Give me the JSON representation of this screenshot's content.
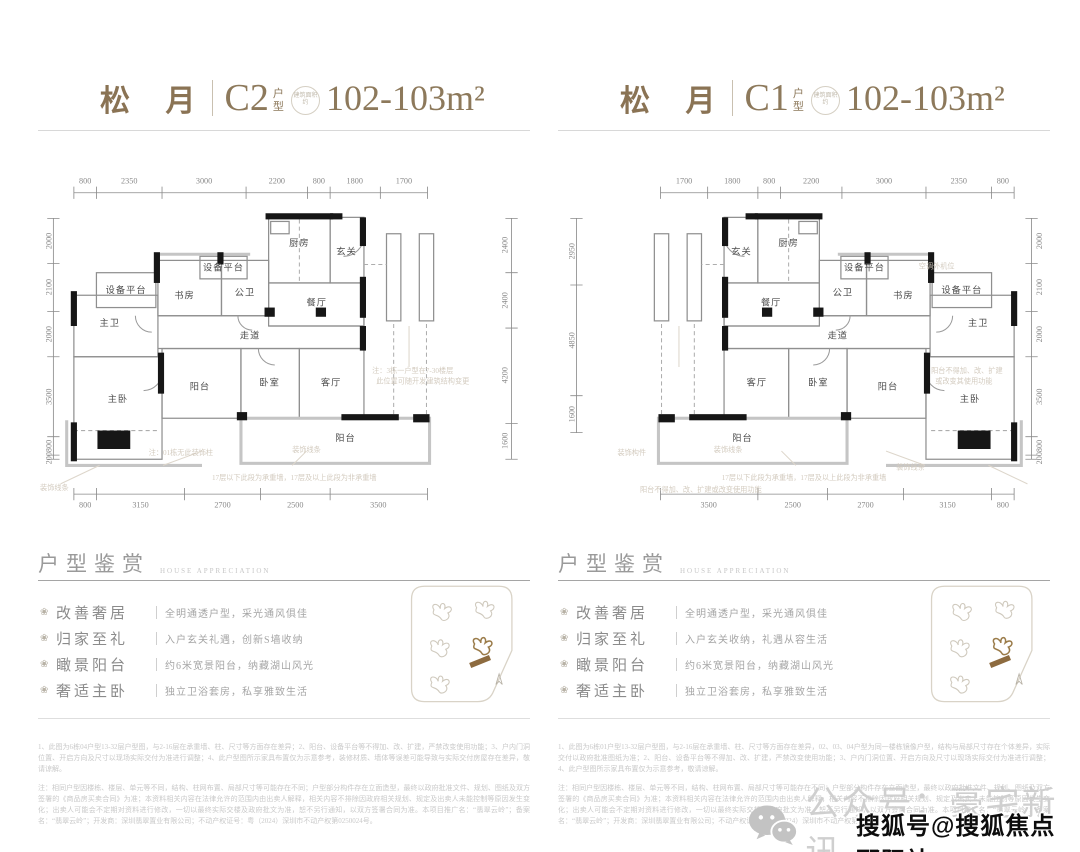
{
  "watermark": {
    "wechat_label": "公众号：豪宅新讯",
    "sohu_label": "搜狐号@搜狐焦点邵阳站"
  },
  "columns": {
    "left": {
      "title": {
        "project": "松 月",
        "type_code": "C2",
        "type_label": "户型",
        "badge": "建筑面积约",
        "area": "102-103m²"
      },
      "plan": {
        "dims_top": [
          "800",
          "2350",
          "3000",
          "2200",
          "800",
          "1800",
          "1700"
        ],
        "dims_bottom": [
          "800",
          "3150",
          "2700",
          "2500",
          "3500"
        ],
        "dims_left": [
          "2000",
          "2100",
          "2000",
          "3500",
          "800",
          "200"
        ],
        "dims_right": [
          "2400",
          "2400",
          "4200",
          "1600"
        ],
        "rooms": {
          "equip_left": "设备平台",
          "equip_up": "设备平台",
          "study": "书房",
          "pub_bath": "公卫",
          "kitchen": "厨房",
          "entry": "玄关",
          "dining": "餐厅",
          "master_bath": "主卫",
          "corridor": "走道",
          "master_bed": "主卧",
          "balcony_small": "阳台",
          "bedroom": "卧室",
          "living": "客厅",
          "balcony_wide": "阳台"
        },
        "notes": {
          "deco_line": "装饰线条",
          "no_column": "注：01栋无此装饰柱",
          "deco_line2": "装饰线条",
          "bearing_wall": "17层以下此段为承重墙，17层及以上此段为非承重墙",
          "floor_note_1": "注：3栋一户型在7-30楼层",
          "floor_note_2": "此位置可随开发建筑结构变更"
        }
      },
      "appreciation": {
        "heading": "户型鉴赏",
        "heading_en": "HOUSE APPRECIATION",
        "features": [
          {
            "key": "改善奢居",
            "value": "全明通透户型，采光通风俱佳"
          },
          {
            "key": "归家至礼",
            "value": "入户玄关礼遇，创新S墙收纳"
          },
          {
            "key": "瞰景阳台",
            "value": "约6米宽景阳台，纳藏湖山风光"
          },
          {
            "key": "奢适主卧",
            "value": "独立卫浴套房，私享雅致生活"
          }
        ]
      },
      "disclaimer": {
        "p1": "1、此图为6栋04户型13-32层户型图，与2-16层在承重墙、柱、尺寸等方面存在差异；2、阳台、设备平台等不得加、改、扩建，严禁改变使用功能；3、户内门洞位置、开启方向及尺寸以现场实际交付为准进行调整；4、此户型图所示家具布置仅为示意参考，装修材质、墙体等误差可能导致与实际交付房屋存在差异，敬请谅解。",
        "p2": "注：相同户型因楼栋、楼层、单元等不同，结构、柱网布置、局部尺寸等可能存在不同；户型部分构件存在立面造型，最终以政府批准文件、规划、图纸及双方签署的《商品房买卖合同》为准；本资料相关内容在法律允许的范围内由出卖人解释，相关内容不排除因政府相关规划、规定及出卖人未能控制等原因发生变化；出卖人可能会不定期对资料进行修改，一切以最终实际交楼及政府批文为准，恕不另行通知，以双方签署合同为准。本项目推广名：“翡翠云岭”；备案名：“翡翠云岭”；开发商：深圳翡翠置业有限公司；不动产权证号：粤（2024）深圳市不动产权第0250024号。"
      }
    },
    "right": {
      "title": {
        "project": "松 月",
        "type_code": "C1",
        "type_label": "户型",
        "badge": "建筑面积约",
        "area": "102-103m²"
      },
      "plan": {
        "dims_top": [
          "1700",
          "1800",
          "800",
          "2200",
          "3000",
          "2350",
          "800"
        ],
        "dims_bottom": [
          "3500",
          "2500",
          "2700",
          "3150",
          "800"
        ],
        "dims_left": [
          "2950",
          "4850",
          "1600"
        ],
        "dims_right": [
          "2000",
          "2100",
          "2000",
          "3500",
          "800",
          "200"
        ],
        "rooms": {
          "equip_left": "设备平台",
          "equip_up": "设备平台",
          "study": "书房",
          "pub_bath": "公卫",
          "kitchen": "厨房",
          "entry": "玄关",
          "dining": "餐厅",
          "master_bath": "主卫",
          "corridor": "走道",
          "master_bed": "主卧",
          "balcony_small": "阳台",
          "bedroom": "卧室",
          "living": "客厅",
          "balcony_wide": "阳台"
        },
        "notes": {
          "ac_unit": "空调外机位",
          "balcony_r1": "阳台不得加、改、扩建",
          "balcony_r2": "或改变其使用功能",
          "deco_part": "装饰构件",
          "deco_line": "装饰线条",
          "bearing_wall": "17层以下此段为承重墙，17层及以上此段为非承重墙",
          "balcony_bottom": "阳台不得加、改、扩建或改变使用功能",
          "deco_line2": "装饰线条"
        }
      },
      "appreciation": {
        "heading": "户型鉴赏",
        "heading_en": "HOUSE APPRECIATION",
        "features": [
          {
            "key": "改善奢居",
            "value": "全明通透户型，采光通风俱佳"
          },
          {
            "key": "归家至礼",
            "value": "入户玄关收纳，礼遇从容生活"
          },
          {
            "key": "瞰景阳台",
            "value": "约6米宽景阳台，纳藏湖山风光"
          },
          {
            "key": "奢适主卧",
            "value": "独立卫浴套房，私享雅致生活"
          }
        ]
      },
      "disclaimer": {
        "p1": "1、此图为6栋01户型13-32层户型图，与2-16层在承重墙、柱、尺寸等方面存在差异，02、03、04户型为同一楼栋镜像户型，结构与局部尺寸存在个体差异，实际交付以政府批准图纸为准；2、阳台、设备平台等不得加、改、扩建，严禁改变使用功能；3、户内门洞位置、开启方向及尺寸以现场实际交付为准进行调整；4、此户型图所示家具布置仅为示意参考，敬请谅解。",
        "p2": "注：相同户型因楼栋、楼层、单元等不同，结构、柱网布置、局部尺寸等可能存在不同；户型部分构件存在立面造型，最终以政府批准文件、规划、图纸及双方签署的《商品房买卖合同》为准；本资料相关内容在法律允许的范围内由出卖人解释，相关内容不排除因政府相关规划、规定及出卖人未能控制等原因发生变化；出卖人可能会不定期对资料进行修改，一切以最终实际交楼及政府批文为准，恕不另行通知，以双方签署合同为准。本项目推广名：“翡翠云岭”；备案名：“翡翠云岭”；开发商：深圳翡翠置业有限公司；不动产权证号：粤（2024）深圳市不动产权第0250024号。"
      }
    }
  }
}
